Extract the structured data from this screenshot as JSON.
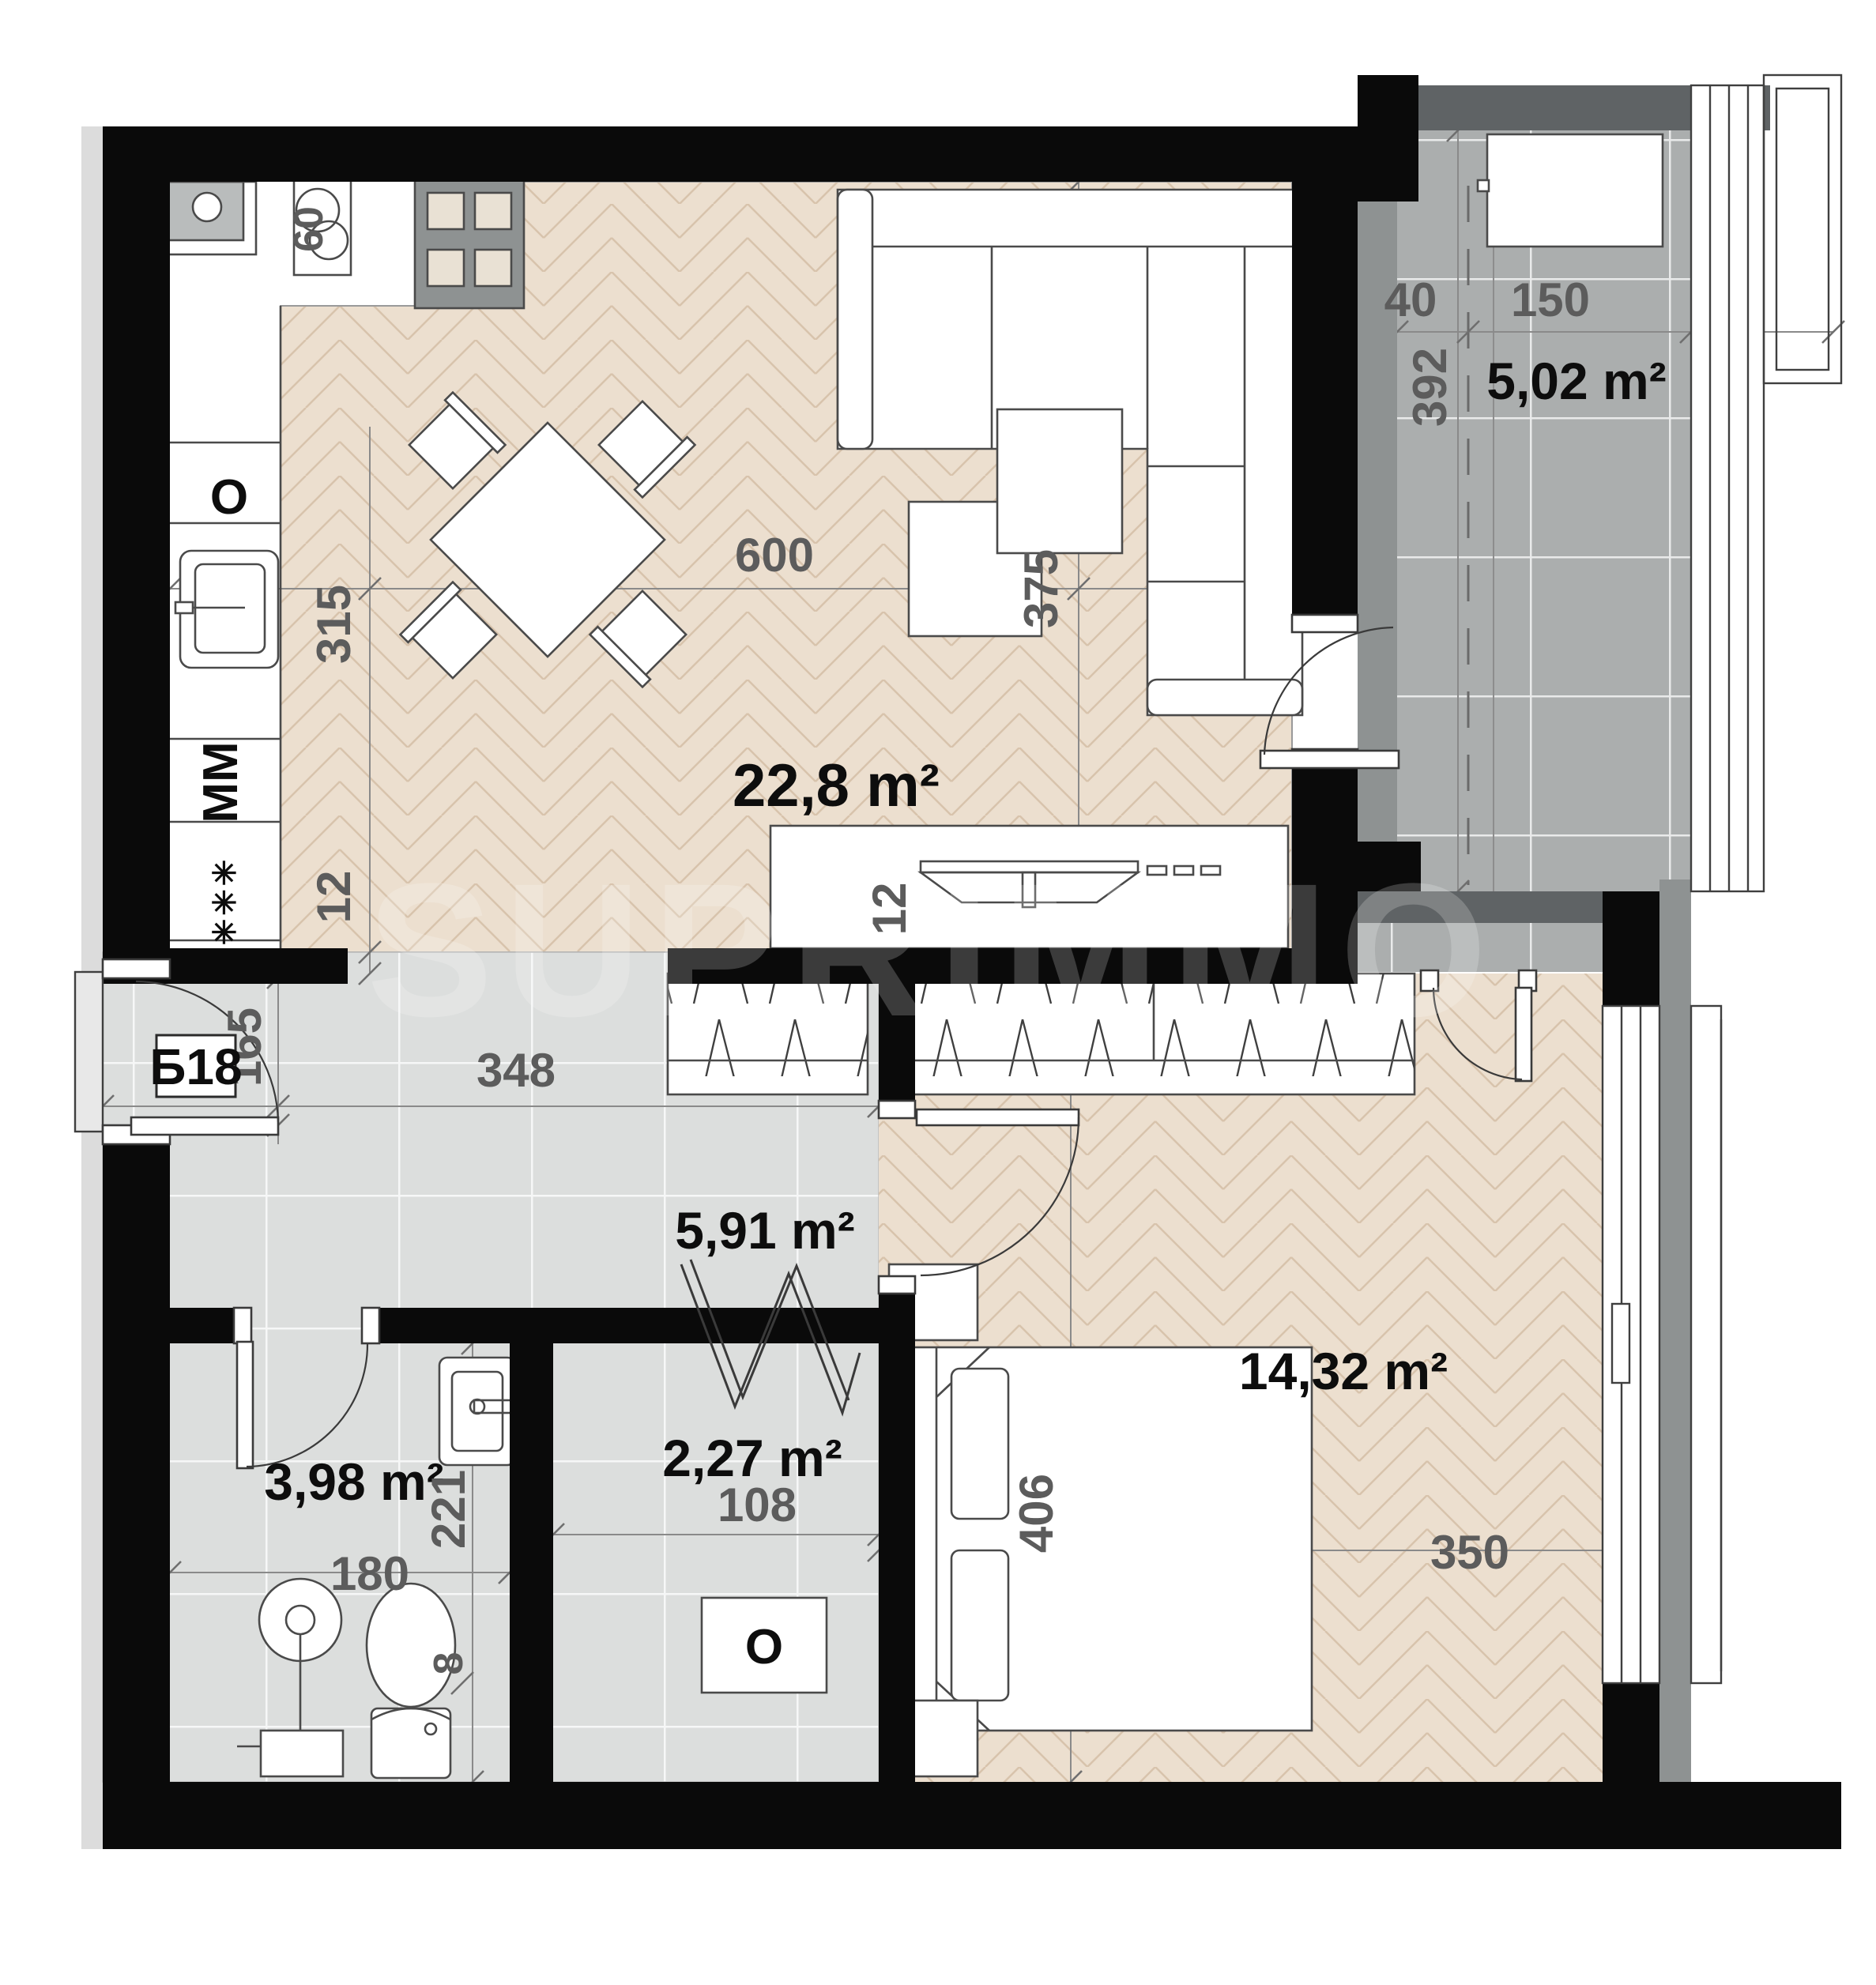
{
  "plan": {
    "unit_label": "Б18",
    "watermark": "SUPRIMMO",
    "rooms": {
      "living_kitchen": {
        "area": "22,8 m²"
      },
      "balcony": {
        "area": "5,02 m²"
      },
      "hallway": {
        "area": "5,91 m²"
      },
      "bedroom": {
        "area": "14,32 m²"
      },
      "bathroom": {
        "area": "3,98 m²"
      },
      "closet": {
        "area": "2,27 m²"
      }
    },
    "dimensions": {
      "living_width": "600",
      "living_depth": "375",
      "kitchen_depth": "315",
      "wall_left_12": "12",
      "wall_tv_12": "12",
      "hall_width": "348",
      "entrance_door": "165",
      "balcony_strip": "40",
      "balcony_width": "150",
      "balcony_length": "392",
      "bedroom_depth": "406",
      "bedroom_width": "350",
      "bath_width": "180",
      "bath_depth": "221",
      "closet_width": "108",
      "wall_8": "8",
      "stove_60": "60"
    },
    "appliances": {
      "oven_symbol": "O",
      "dishwasher_symbol": "MM",
      "freezer_symbols": "✳✳✳",
      "boiler_symbol": "O"
    },
    "colors": {
      "wall": "#0a0a0a",
      "wall_gray": "#8e9292",
      "balcony_band": "#5f6365",
      "parquet": "#ecdfcf",
      "parquet_stroke": "#d8c3ac",
      "tile": "#dcdedd",
      "balcony_tile": "#abaeae",
      "dim_text": "#5c5c5c",
      "area_text": "#0d0d0d"
    }
  }
}
